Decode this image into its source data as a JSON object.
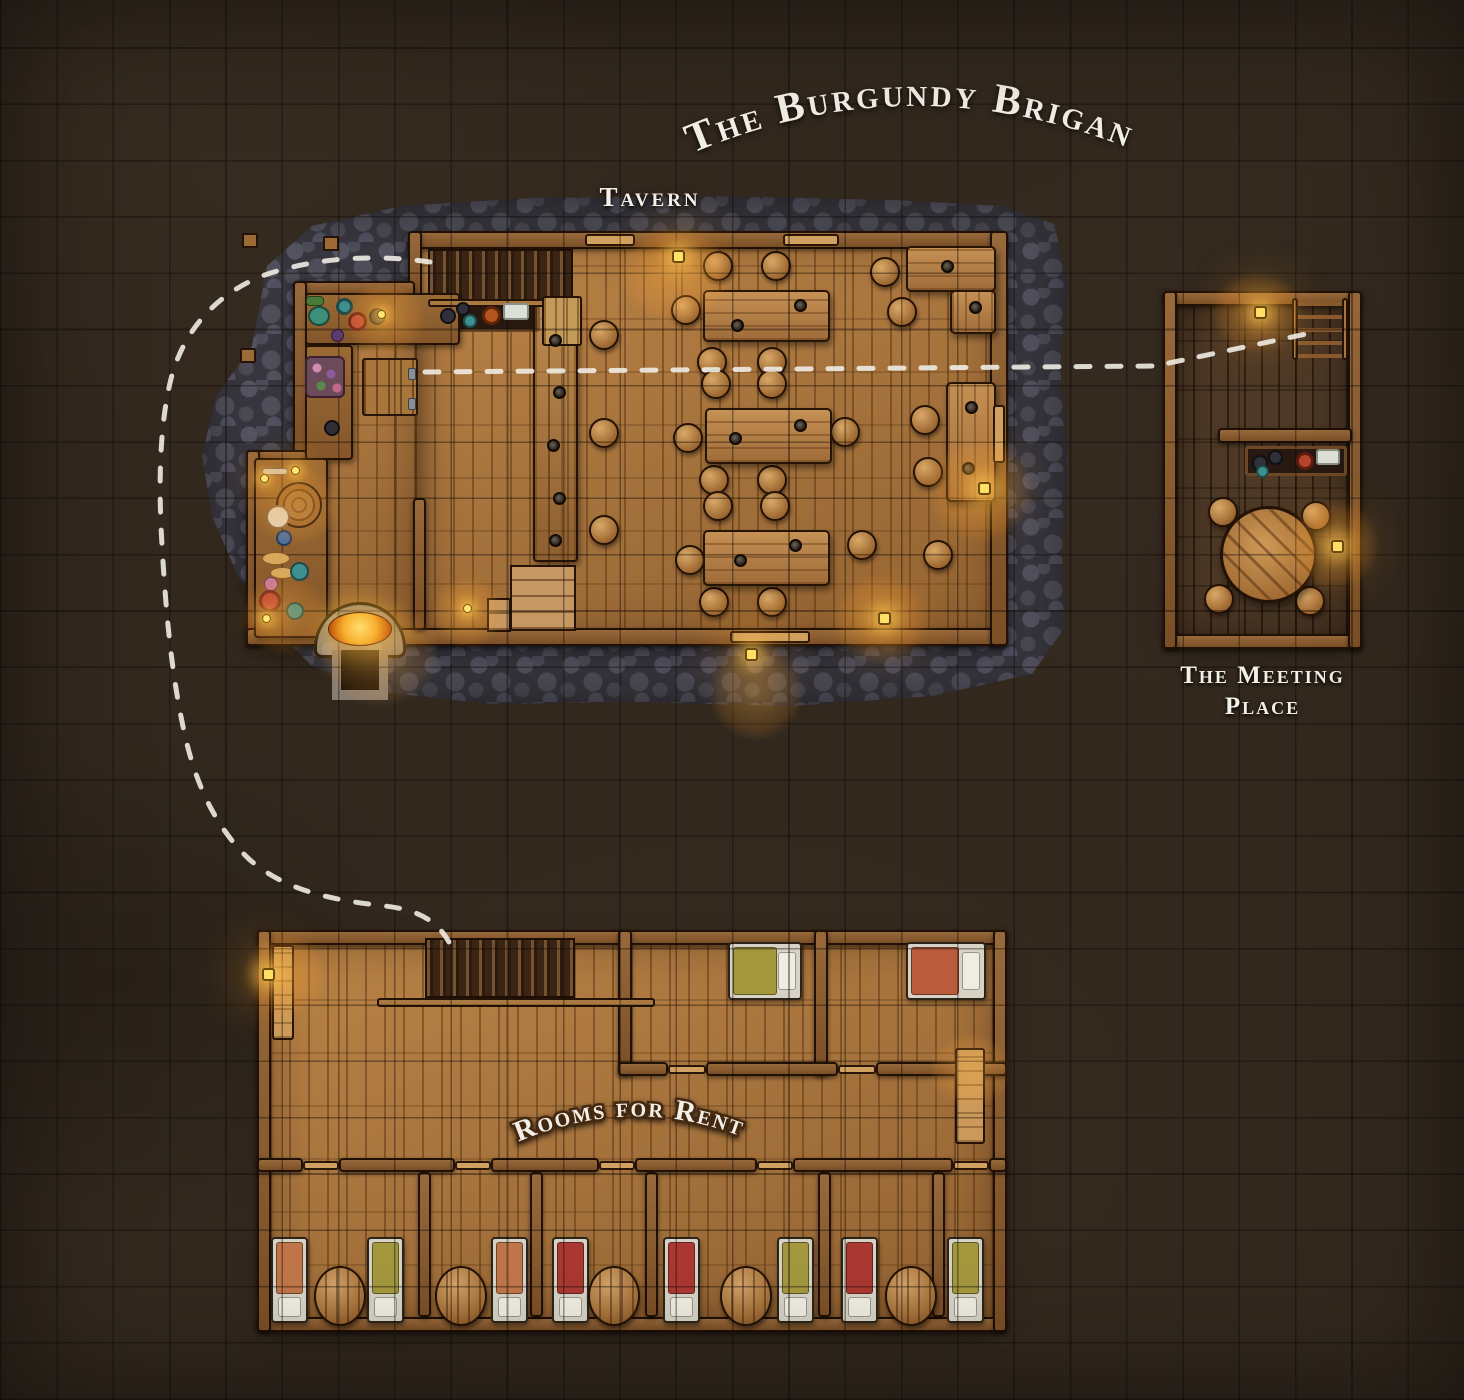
{
  "title": "The Burgundy Brigand",
  "labels": {
    "tavern": "Tavern",
    "meeting_line1": "The Meeting",
    "meeting_line2": "Place",
    "rooms_for_rent": "Rooms for Rent"
  },
  "palette": {
    "ground": "#32281e",
    "grid_line": "#1c130c",
    "cobblestone": "#4c4b56",
    "floor_wood": "#b0793f",
    "floor_wood_dark": "#4e3926",
    "wall_wood": "#7b4f26",
    "table_wood": "#bb8248",
    "lamp_glow": "#ffc95a",
    "path_dashes": "#efece4",
    "label_text": "#f3efe6",
    "bed_red": "#ab3832",
    "bed_olive": "#a3983e",
    "bed_orange": "#c0764a",
    "fire": "#f7c12c"
  }
}
